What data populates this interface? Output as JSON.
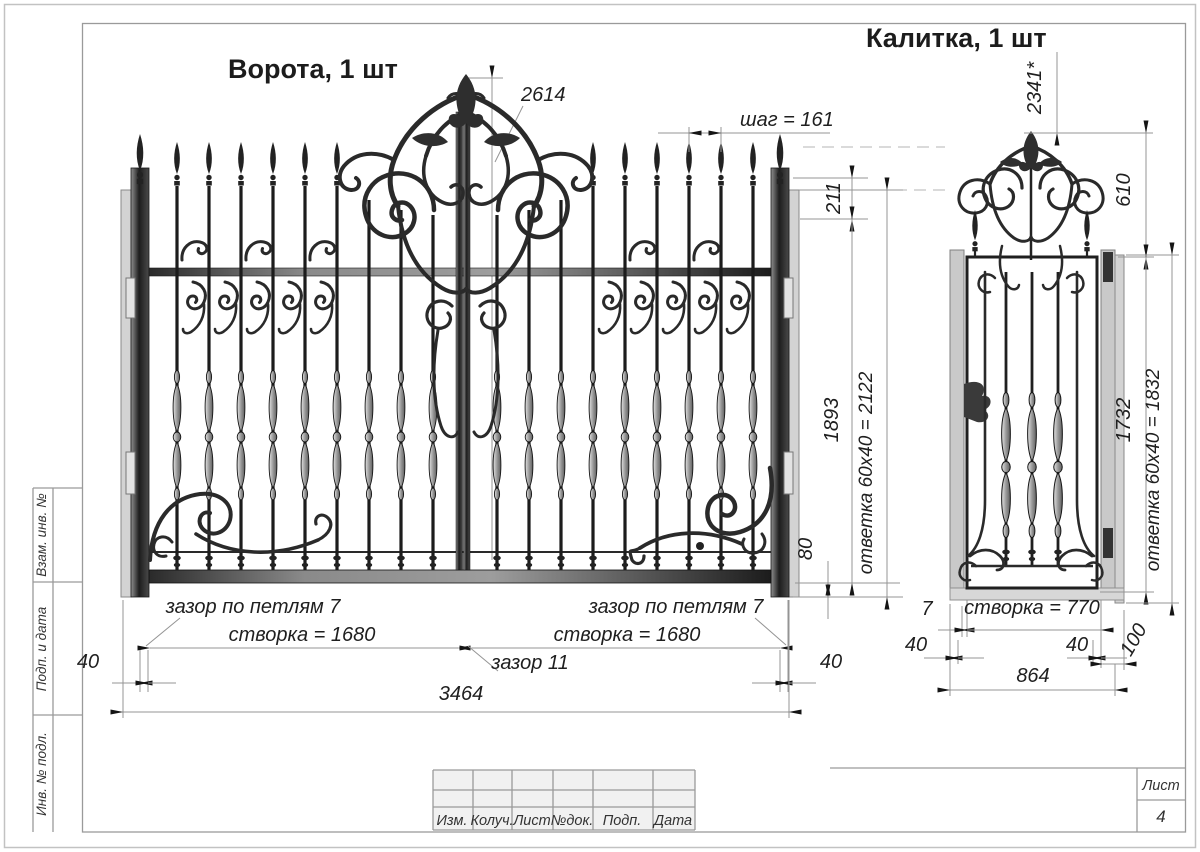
{
  "titles": {
    "gate": "Ворота, 1 шт",
    "wicket": "Калитка, 1 шт"
  },
  "gate_dims": {
    "height_center": "2614",
    "picket_step": "шаг = 161",
    "top_offset": "211",
    "leaf_height": "1893",
    "strike_plate": "ответка 60х40 = 2122",
    "bottom_rail": "80",
    "hinge_gap_left": "зазор по петлям 7",
    "hinge_gap_right": "зазор по петлям 7",
    "leaf_width_left": "створка = 1680",
    "leaf_width_right": "створка = 1680",
    "center_gap": "зазор 11",
    "edge_offset_left": "40",
    "edge_offset_right": "40",
    "total_width": "3464"
  },
  "wicket_dims": {
    "total_height": "2341*",
    "crown_height": "610",
    "leaf_height": "1732",
    "strike_plate": "ответка 60х40 = 1832",
    "hinge_gap": "7",
    "leaf_width": "створка = 770",
    "edge_offset_left": "40",
    "edge_offset_right": "40",
    "strike_offset": "100",
    "total_width": "864"
  },
  "margin_column": {
    "labels": [
      "Взам. инв. №",
      "Подп. и дата",
      "Инв. № подл."
    ]
  },
  "title_block": {
    "columns": [
      "Изм.",
      "Колуч.",
      "Лист",
      "№док.",
      "Подп.",
      "Дата"
    ]
  },
  "sheet_info": {
    "sheet_label": "Лист",
    "sheet_number": "4"
  },
  "colors": {
    "ink": "#1f1f1f",
    "dim_line": "#949494",
    "frame": "#9a9a9a",
    "metal_light": "#cfcfcf",
    "metal_dark": "#2b2b2b"
  }
}
